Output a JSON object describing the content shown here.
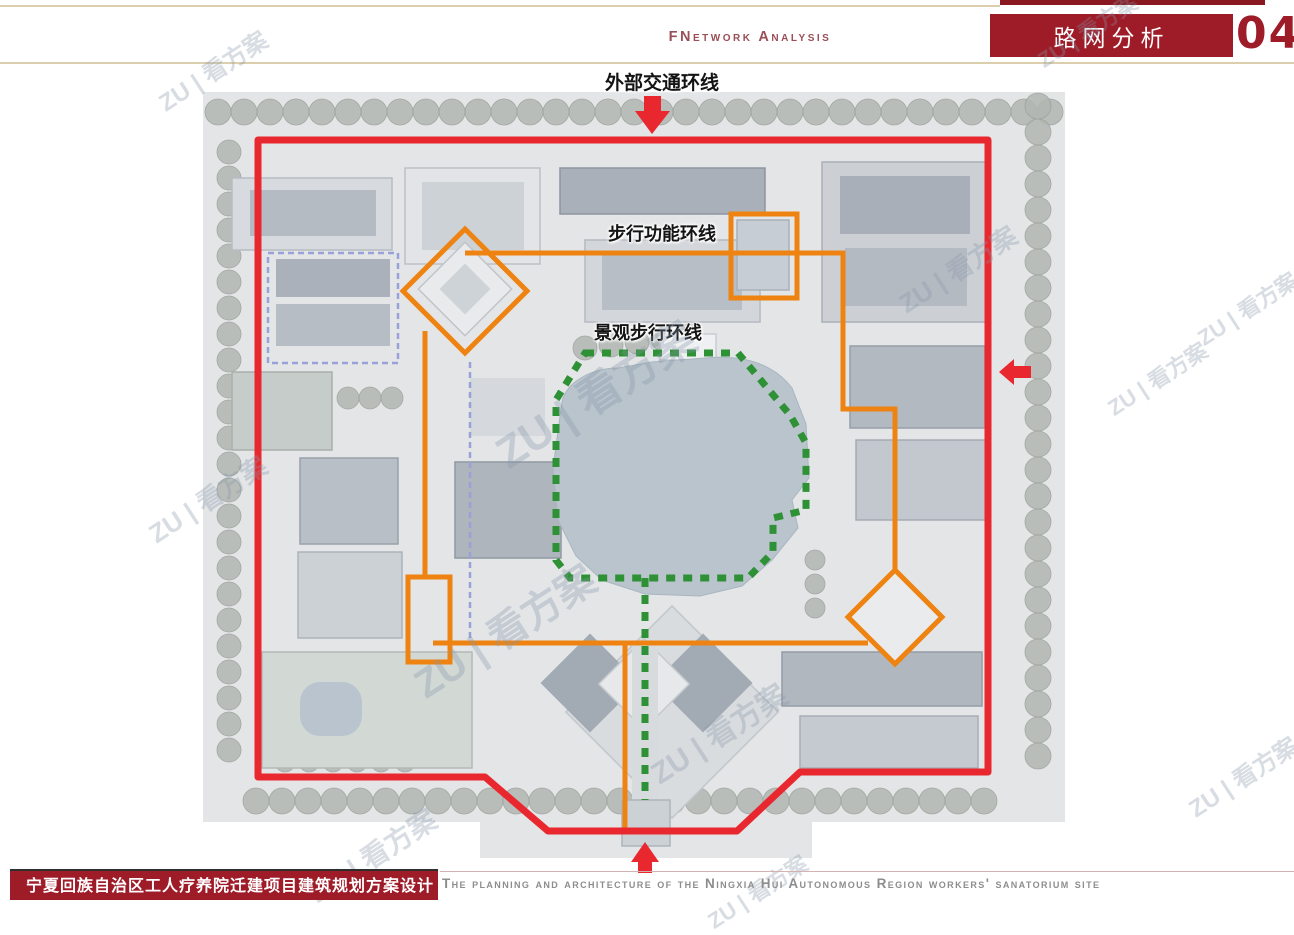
{
  "header": {
    "subtitle_en": "FNetwork Analysis",
    "title": "路网分析",
    "page_number": "04"
  },
  "footer": {
    "project_title": "宁夏回族自治区工人疗养院迁建项目建筑规划方案设计",
    "caption_en": "The planning and architecture of the Ningxia Hui Autonomous Region workers' sanatorium site"
  },
  "watermark": {
    "text": "ZU | 看方案",
    "instances": [
      {
        "x": 150,
        "y": 52,
        "size": 24
      },
      {
        "x": 1030,
        "y": 14,
        "size": 22
      },
      {
        "x": 890,
        "y": 250,
        "size": 26
      },
      {
        "x": 1100,
        "y": 362,
        "size": 22
      },
      {
        "x": 140,
        "y": 480,
        "size": 26
      },
      {
        "x": 480,
        "y": 360,
        "size": 44
      },
      {
        "x": 400,
        "y": 600,
        "size": 40
      },
      {
        "x": 640,
        "y": 710,
        "size": 30
      },
      {
        "x": 300,
        "y": 835,
        "size": 28
      },
      {
        "x": 700,
        "y": 875,
        "size": 22
      },
      {
        "x": 1190,
        "y": 292,
        "size": 22
      },
      {
        "x": 1180,
        "y": 758,
        "size": 24
      }
    ]
  },
  "map": {
    "labels": {
      "outer_ring": "外部交通环线",
      "pedestrian_ring": "步行功能环线",
      "landscape_ring": "景观步行环线"
    },
    "colors": {
      "outer": "#e8282e",
      "pedestrian": "#ee8312",
      "landscape": "#2e9135",
      "purple_dash": "#9aa0d8",
      "lake": "#b9c4cd",
      "ground": "#e3e5e7",
      "tree": "#b2b7b2",
      "accent_red": "#9e1b28"
    },
    "tree_rows": [
      {
        "x": 218,
        "y": 112,
        "dx": 26,
        "dy": 0,
        "n": 33,
        "r": 13
      },
      {
        "x": 229,
        "y": 152,
        "dx": 0,
        "dy": 26,
        "n": 24,
        "r": 12
      },
      {
        "x": 1038,
        "y": 106,
        "dx": 0,
        "dy": 26,
        "n": 26,
        "r": 13
      },
      {
        "x": 256,
        "y": 801,
        "dx": 26,
        "dy": 0,
        "n": 29,
        "r": 13
      },
      {
        "x": 348,
        "y": 398,
        "dx": 22,
        "dy": 0,
        "n": 3,
        "r": 11
      },
      {
        "x": 585,
        "y": 348,
        "dx": 26,
        "dy": -3,
        "n": 5,
        "r": 12
      },
      {
        "x": 285,
        "y": 762,
        "dx": 24,
        "dy": 0,
        "n": 6,
        "r": 10
      },
      {
        "x": 815,
        "y": 560,
        "dx": 0,
        "dy": 24,
        "n": 3,
        "r": 10
      }
    ],
    "buildings": [
      {
        "x": 232,
        "y": 178,
        "w": 160,
        "h": 72,
        "f": "#d7dade",
        "s": "#b6bcc2"
      },
      {
        "x": 250,
        "y": 190,
        "w": 126,
        "h": 46,
        "f": "#b5bbc3"
      },
      {
        "x": 405,
        "y": 168,
        "w": 135,
        "h": 96,
        "f": "#e2e4e7",
        "s": "#bcc1c7"
      },
      {
        "x": 422,
        "y": 182,
        "w": 102,
        "h": 68,
        "f": "#cdd2d7"
      },
      {
        "x": 560,
        "y": 168,
        "w": 205,
        "h": 46,
        "f": "#a9b0b9",
        "s": "#8e95a0"
      },
      {
        "x": 585,
        "y": 240,
        "w": 175,
        "h": 82,
        "f": "#d3d7db",
        "s": "#b4bac1"
      },
      {
        "x": 602,
        "y": 252,
        "w": 140,
        "h": 58,
        "f": "#b8bec5"
      },
      {
        "x": 822,
        "y": 162,
        "w": 165,
        "h": 160,
        "f": "#ccd0d5",
        "s": "#aab0b7"
      },
      {
        "x": 840,
        "y": 176,
        "w": 130,
        "h": 58,
        "f": "#a8afb8"
      },
      {
        "x": 845,
        "y": 248,
        "w": 122,
        "h": 58,
        "f": "#b4bac2"
      },
      {
        "x": 850,
        "y": 346,
        "w": 135,
        "h": 82,
        "f": "#b2b9c1",
        "s": "#979ea8"
      },
      {
        "x": 856,
        "y": 440,
        "w": 130,
        "h": 80,
        "f": "#c2c8ce",
        "s": "#a5abb3"
      },
      {
        "x": 268,
        "y": 253,
        "w": 130,
        "h": 110,
        "f": "none",
        "s": "#9aa0d8",
        "dash": "6 4",
        "sw": 2.5
      },
      {
        "x": 276,
        "y": 259,
        "w": 114,
        "h": 38,
        "f": "#abb1bb"
      },
      {
        "x": 276,
        "y": 304,
        "w": 114,
        "h": 42,
        "f": "#b7bdc5"
      },
      {
        "x": 232,
        "y": 372,
        "w": 100,
        "h": 78,
        "f": "#c6ccc9",
        "s": "#a9b0ab"
      },
      {
        "x": 300,
        "y": 458,
        "w": 98,
        "h": 86,
        "f": "#b9bfc7",
        "s": "#9aa1aa"
      },
      {
        "x": 298,
        "y": 552,
        "w": 104,
        "h": 86,
        "f": "#ccd1d6",
        "s": "#adb3ba"
      },
      {
        "x": 262,
        "y": 652,
        "w": 210,
        "h": 116,
        "f": "#d2d8d4",
        "s": "#b3bab5"
      },
      {
        "x": 455,
        "y": 462,
        "w": 106,
        "h": 96,
        "f": "#aeb5bd",
        "s": "#9099a2"
      },
      {
        "x": 470,
        "y": 378,
        "w": 75,
        "h": 58,
        "f": "#d5d8dc"
      },
      {
        "x": 737,
        "y": 220,
        "w": 52,
        "h": 70,
        "f": "#c7cdd4",
        "s": "#a9b0ba"
      },
      {
        "x": 782,
        "y": 652,
        "w": 200,
        "h": 54,
        "f": "#b1b7bf",
        "s": "#959ca6"
      },
      {
        "x": 800,
        "y": 716,
        "w": 178,
        "h": 52,
        "f": "#c5cad0",
        "s": "#a8aeb5"
      },
      {
        "x": 597,
        "y": 637,
        "w": 150,
        "h": 150,
        "rot": 45,
        "f": "#d9dcdf",
        "s": "#c2c7cc"
      },
      {
        "x": 555,
        "y": 648,
        "w": 70,
        "h": 70,
        "rot": 45,
        "f": "#a2aab3"
      },
      {
        "x": 668,
        "y": 648,
        "w": 70,
        "h": 70,
        "rot": 45,
        "f": "#a2aab3"
      },
      {
        "x": 612,
        "y": 652,
        "w": 64,
        "h": 64,
        "rot": 45,
        "f": "#e6e8ea",
        "s": "#c4c9ce"
      },
      {
        "x": 632,
        "y": 645,
        "w": 26,
        "h": 180,
        "f": "#d8dbde"
      },
      {
        "x": 622,
        "y": 800,
        "w": 48,
        "h": 46,
        "f": "#ccd1d6",
        "s": "#aeb4ba"
      },
      {
        "x": 862,
        "y": 584,
        "w": 66,
        "h": 66,
        "rot": 45,
        "f": "#e9ebec",
        "s": "#b9bfc4"
      },
      {
        "x": 432,
        "y": 256,
        "w": 66,
        "h": 66,
        "rot": 45,
        "f": "#e8eaec",
        "s": "#c0c5ca"
      },
      {
        "x": 447,
        "y": 271,
        "w": 36,
        "h": 36,
        "rot": 45,
        "f": "#ced3d8"
      },
      {
        "x": 660,
        "y": 334,
        "w": 56,
        "h": 26,
        "f": "#eef0f2",
        "s": "#c8cdd2"
      },
      {
        "x": 300,
        "y": 682,
        "w": 62,
        "h": 54,
        "f": "#b9c4cf",
        "rx": 20
      }
    ],
    "lake_path": "M562,402 C566,382 592,368 618,368 L652,362 L705,358 C748,354 775,366 792,388 L806,424 L809,478 L792,500 L798,528 L772,560 L742,586 L700,596 L645,594 L602,580 L576,556 L558,520 L553,468 Z",
    "purple_segments": [
      [
        [
          470,
          362
        ],
        [
          470,
          640
        ]
      ]
    ],
    "routes": {
      "outer_ring": [
        [
          258,
          140
        ],
        [
          988,
          140
        ],
        [
          988,
          772
        ],
        [
          800,
          772
        ],
        [
          737,
          831
        ],
        [
          548,
          831
        ],
        [
          485,
          777
        ],
        [
          258,
          777
        ]
      ],
      "pedestrian_segments": [
        [
          [
            465,
            253
          ],
          [
            843,
            253
          ],
          [
            843,
            409
          ],
          [
            895,
            409
          ],
          [
            895,
            572
          ]
        ],
        [
          [
            868,
            643
          ],
          [
            433,
            643
          ]
        ],
        [
          [
            425,
            331
          ],
          [
            425,
            577
          ]
        ],
        [
          [
            625,
            645
          ],
          [
            625,
            830
          ]
        ]
      ],
      "pedestrian_rects": [
        [
          731,
          214,
          66,
          84
        ],
        [
          408,
          577,
          42,
          85
        ]
      ],
      "pedestrian_diamonds": [
        [
          465,
          291,
          62
        ],
        [
          895,
          617,
          47
        ]
      ],
      "landscape_loop": [
        [
          585,
          353
        ],
        [
          738,
          353
        ],
        [
          790,
          415
        ],
        [
          806,
          443
        ],
        [
          806,
          510
        ],
        [
          773,
          518
        ],
        [
          773,
          552
        ],
        [
          748,
          578
        ],
        [
          570,
          578
        ],
        [
          556,
          560
        ],
        [
          556,
          400
        ]
      ],
      "landscape_stem": [
        [
          645,
          578
        ],
        [
          645,
          800
        ]
      ]
    },
    "arrows": [
      {
        "dir": "down",
        "points": [
          [
            644,
            96
          ],
          [
            661,
            96
          ],
          [
            661,
            111
          ],
          [
            670,
            111
          ],
          [
            652,
            134
          ],
          [
            635,
            111
          ],
          [
            644,
            111
          ]
        ]
      },
      {
        "dir": "left",
        "points": [
          [
            999,
            372
          ],
          [
            1014,
            359
          ],
          [
            1014,
            366
          ],
          [
            1031,
            366
          ],
          [
            1031,
            378
          ],
          [
            1014,
            378
          ],
          [
            1014,
            385
          ]
        ]
      },
      {
        "dir": "up",
        "points": [
          [
            645,
            842
          ],
          [
            659,
            862
          ],
          [
            652,
            862
          ],
          [
            652,
            873
          ],
          [
            638,
            873
          ],
          [
            638,
            862
          ],
          [
            631,
            862
          ]
        ]
      }
    ]
  }
}
